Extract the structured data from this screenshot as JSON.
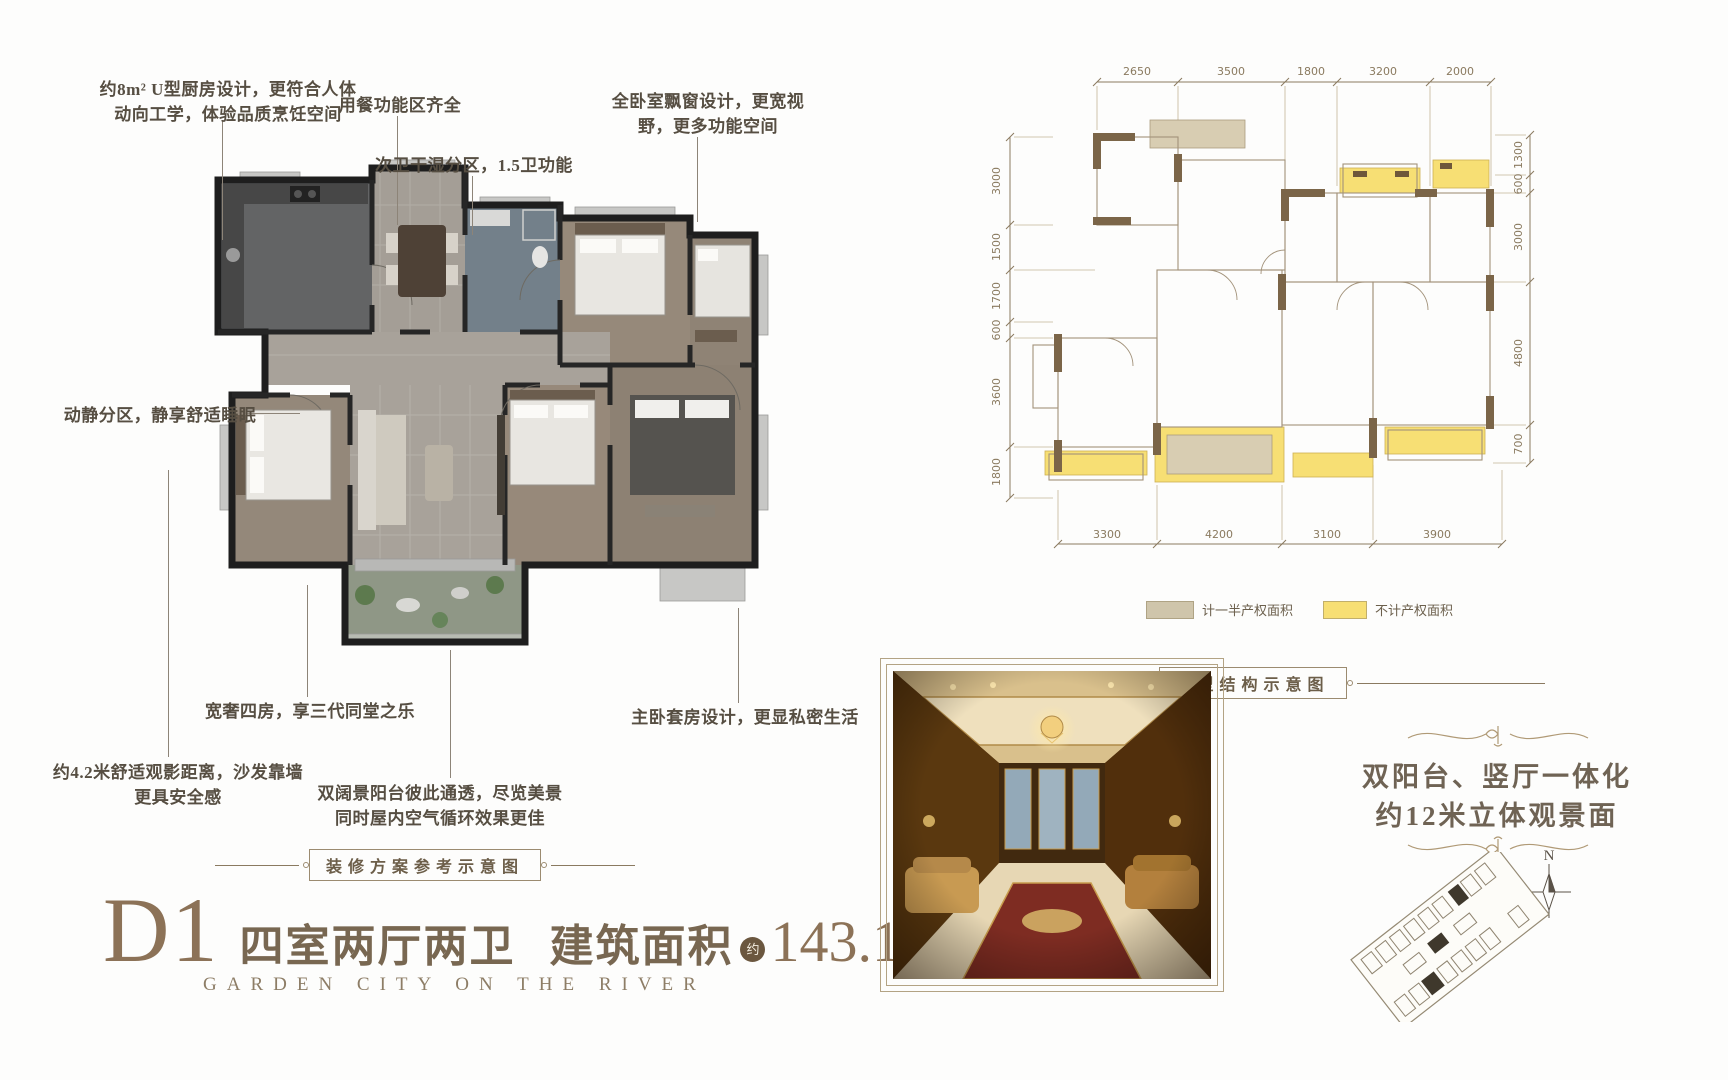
{
  "left_plan": {
    "caption": "装修方案参考示意图",
    "annotations": {
      "kitchen_l1": "约8m² U型厨房设计，更符合人体",
      "kitchen_l2": "动向工学，体验品质烹饪空间",
      "dining": "用餐功能区齐全",
      "bath": "次卫干湿分区，1.5卫功能",
      "bay_l1": "全卧室飘窗设计，更宽视",
      "bay_l2": "野，更多功能空间",
      "quiet": "动静分区，静享舒适睡眠",
      "four_rooms": "宽奢四房，享三代同堂之乐",
      "sofa_l1": "约4.2米舒适观影距离，沙发靠墙",
      "sofa_l2": "更具安全感",
      "balcony_l1": "双阔景阳台彼此通透，尽览美景",
      "balcony_l2": "同时屋内空气循环效果更佳",
      "master": "主卧套房设计，更显私密生活"
    }
  },
  "title": {
    "code": "D1",
    "layout": "四室两厅两卫",
    "area_label": "建筑面积",
    "approx_badge": "约",
    "area_value": "143.19m",
    "area_sup": "2",
    "subtitle": "GARDEN CITY ON THE RIVER"
  },
  "tech_plan": {
    "caption": "户型结构示意图",
    "dims_top": [
      "2650",
      "3500",
      "1800",
      "3200",
      "2000"
    ],
    "dims_left": [
      "3000",
      "1500",
      "1700",
      "600",
      "3600",
      "1800"
    ],
    "dims_right": [
      "1300",
      "600",
      "3000",
      "4800",
      "700"
    ],
    "dims_bottom": [
      "3300",
      "4200",
      "3100",
      "3900"
    ],
    "legend": {
      "half_label": "计一半产权面积",
      "half_color": "#cfc5ab",
      "none_label": "不计产权面积",
      "none_color": "#f7df74"
    }
  },
  "feature": {
    "line1": "双阳台、竖厅一体化",
    "line2": "约12米立体观景面",
    "compass_n": "N"
  }
}
